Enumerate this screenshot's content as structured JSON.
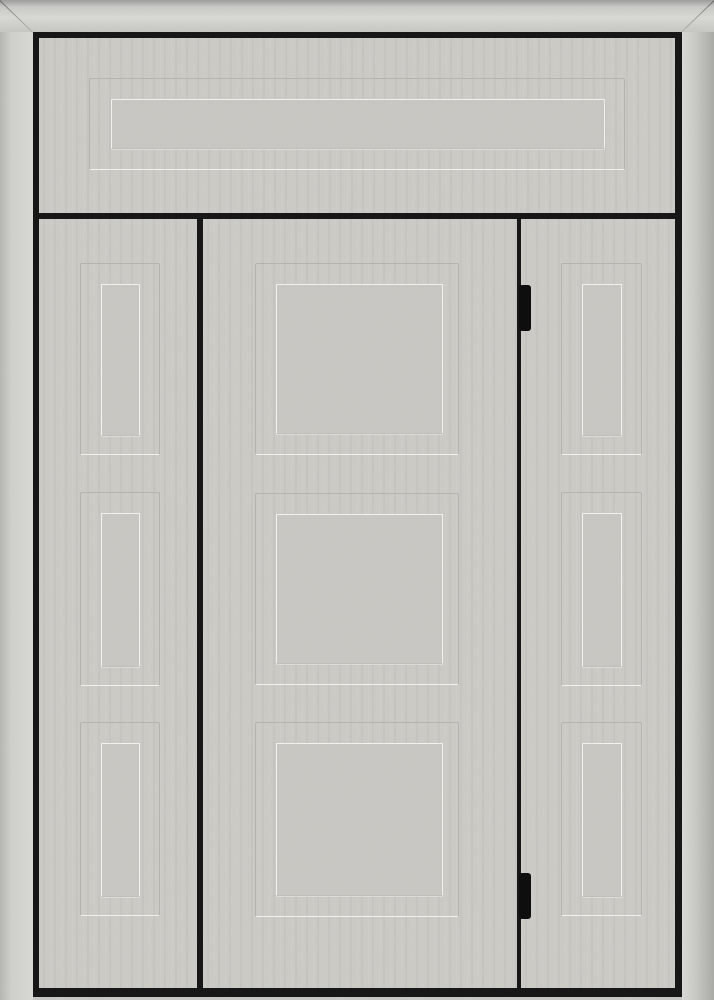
{
  "scene": {
    "subject": "paneled entry door unit with two sidelights and transom in a stainless-steel frame",
    "transom": {
      "panels": 1,
      "panel_style": "recessed horizontal rectangle"
    },
    "door": {
      "panels": 3,
      "panel_style": "recessed squares",
      "hinge_side": "right"
    },
    "sidelights": {
      "count": 2,
      "panels_each": 3,
      "panel_style": "recessed vertical rectangles"
    },
    "hinges": {
      "count": 2
    },
    "visible_text": ""
  },
  "colors": {
    "face": "#cbcac5",
    "face_inner": "#c8c7c2",
    "line_dark": "#b4b3ae",
    "line_light": "#f3f2ef",
    "frame_black": "#141414",
    "metal_light": "#d8d8d4",
    "metal_mid": "#cfcfcb",
    "metal_dark": "#9c9c9a",
    "hinge": "#0b0b0b",
    "sill": "#c6c6c2"
  }
}
